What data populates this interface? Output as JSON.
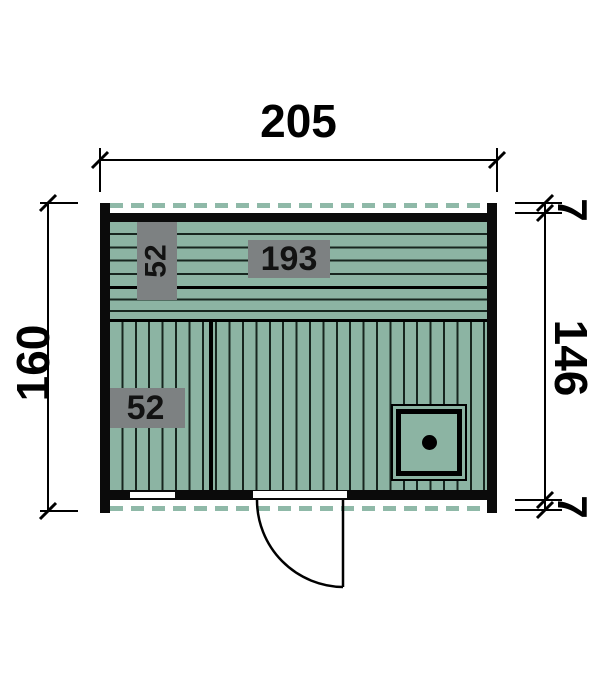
{
  "title": "Sauna cabin floor plan",
  "colors": {
    "plank_green": "#8cb4a3",
    "dash_green": "#8fb9a8",
    "plank_line": "#17261f",
    "wall_black": "#0b0b0b",
    "label_gray": "#7d8182"
  },
  "dimensions": {
    "width_top": "205",
    "height_left": "160",
    "height_right": "146",
    "overhang_top": "7",
    "overhang_bottom": "7"
  },
  "interior_labels": {
    "bench_depth_vertical": "52",
    "bench_length": "193",
    "floor_section_depth": "52"
  }
}
